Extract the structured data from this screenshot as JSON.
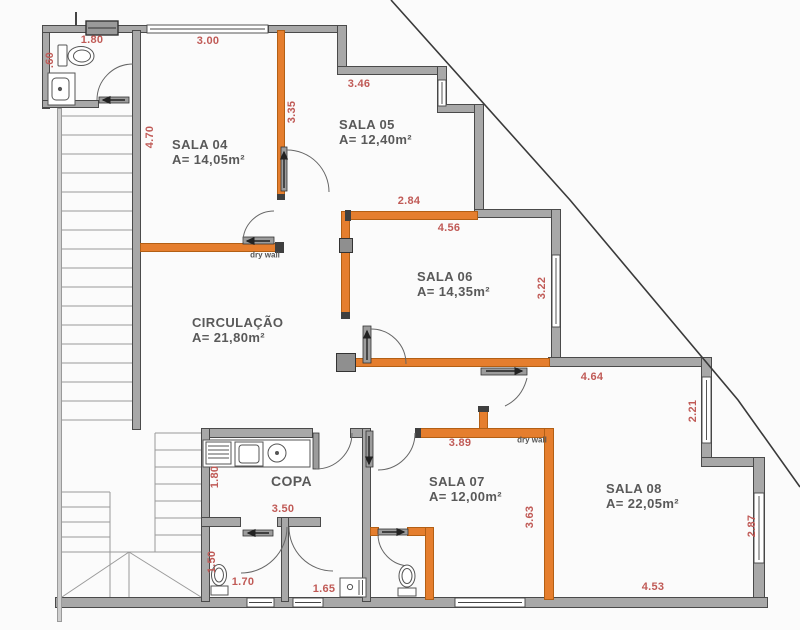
{
  "colors": {
    "bg": "#FBFBFB",
    "wall_gray": "#A8A8A8",
    "wall_orange": "#E57E2E",
    "dim_red": "#C05A56",
    "label_gray": "#595959"
  },
  "rooms": {
    "sala04": {
      "name": "SALA 04",
      "area": "A= 14,05m²"
    },
    "sala05": {
      "name": "SALA 05",
      "area": "A= 12,40m²"
    },
    "sala06": {
      "name": "SALA 06",
      "area": "A= 14,35m²"
    },
    "sala07": {
      "name": "SALA 07",
      "area": "A= 12,00m²"
    },
    "sala08": {
      "name": "SALA 08",
      "area": "A= 22,05m²"
    },
    "circulacao": {
      "name": "CIRCULAÇÃO",
      "area": "A= 21,80m²"
    },
    "copa": {
      "name": "COPA"
    }
  },
  "annotations": {
    "drywall": "dry wall"
  },
  "dims": {
    "bath_top": "1.80",
    "bath_side": ".60",
    "sala04_top": "3.00",
    "sala04_right": "3.35",
    "stairs_side": "4.70",
    "sala05_top": "3.46",
    "sala05_bottom": "2.84",
    "sala06_top": "4.56",
    "sala06_right": "3.22",
    "sala08_top": "4.64",
    "sala08_window": "2.21",
    "sala08_right": "2.87",
    "sala08_bottom": "4.53",
    "sala07_top": "3.89",
    "sala07_right": "3.63",
    "copa_width": "3.50",
    "copa_left": "1.80",
    "wc1_left": "1.50",
    "wc1_width": "1.70",
    "wc2_width": "1.65"
  }
}
